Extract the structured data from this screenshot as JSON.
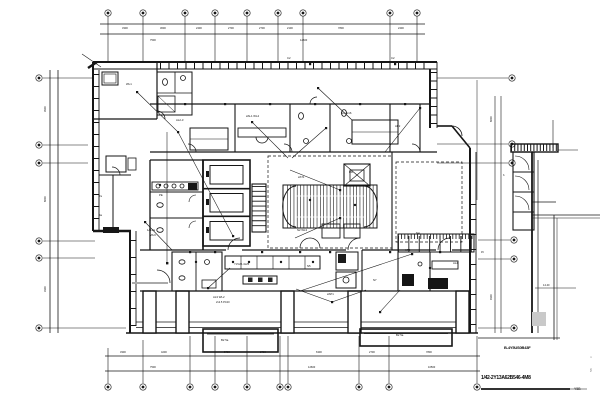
{
  "meta": {
    "drawing_type": "electrical floor plan",
    "background_color": "#ffffff",
    "line_color": "#161616",
    "gray_fill": "#c9c9c9"
  },
  "titleblock": {
    "drawing_title": "1/42-2Y13A62B546-4M8",
    "scale_note": "Y5B"
  },
  "captions": {
    "right_note": "B-4Y5US0B43F"
  },
  "annotations": [
    {
      "x": 122,
      "y": 29,
      "t": "3300",
      "s": 2.6
    },
    {
      "x": 160,
      "y": 29,
      "t": "3600",
      "s": 2.6
    },
    {
      "x": 196,
      "y": 29,
      "t": "2400",
      "s": 2.6
    },
    {
      "x": 228,
      "y": 29,
      "t": "2700",
      "s": 2.6
    },
    {
      "x": 259,
      "y": 29,
      "t": "2700",
      "s": 2.6
    },
    {
      "x": 287,
      "y": 29,
      "t": "2100",
      "s": 2.6
    },
    {
      "x": 338,
      "y": 29,
      "t": "7800",
      "s": 2.6
    },
    {
      "x": 398,
      "y": 29,
      "t": "2400",
      "s": 2.6
    },
    {
      "x": 150,
      "y": 41,
      "t": "7500",
      "s": 2.6
    },
    {
      "x": 300,
      "y": 41,
      "t": "12600",
      "s": 2.6
    },
    {
      "x": 46,
      "y": 112,
      "t": "3900",
      "s": 2.6,
      "r": -90
    },
    {
      "x": 46,
      "y": 202,
      "t": "6600",
      "s": 2.6,
      "r": -90
    },
    {
      "x": 46,
      "y": 292,
      "t": "3300",
      "s": 2.6,
      "r": -90
    },
    {
      "x": 120,
      "y": 353,
      "t": "3300",
      "s": 2.6
    },
    {
      "x": 161,
      "y": 353,
      "t": "4200",
      "s": 2.6
    },
    {
      "x": 224,
      "y": 353,
      "t": "5700",
      "s": 2.6
    },
    {
      "x": 260,
      "y": 353,
      "t": "2700",
      "s": 2.6
    },
    {
      "x": 316,
      "y": 353,
      "t": "6300",
      "s": 2.6
    },
    {
      "x": 369,
      "y": 353,
      "t": "2700",
      "s": 2.6
    },
    {
      "x": 426,
      "y": 353,
      "t": "7800",
      "s": 2.6
    },
    {
      "x": 150,
      "y": 368,
      "t": "7500",
      "s": 2.6
    },
    {
      "x": 308,
      "y": 368,
      "t": "12600",
      "s": 2.6
    },
    {
      "x": 428,
      "y": 368,
      "t": "10500",
      "s": 2.6
    },
    {
      "x": 492,
      "y": 122,
      "t": "6600",
      "s": 2.6,
      "r": -90
    },
    {
      "x": 492,
      "y": 300,
      "t": "9300",
      "s": 2.6,
      "r": -90
    },
    {
      "x": 543,
      "y": 286,
      "t": "14.40",
      "s": 2.6
    },
    {
      "x": 176,
      "y": 121,
      "t": "AL2-3",
      "s": 2.8
    },
    {
      "x": 246,
      "y": 117,
      "t": "2AL1 WL4",
      "s": 2.8
    },
    {
      "x": 341,
      "y": 114,
      "t": "N3 2x16",
      "s": 2.8
    },
    {
      "x": 395,
      "y": 127,
      "t": "AP2",
      "s": 2.8
    },
    {
      "x": 147,
      "y": 231,
      "t": "1AL2a",
      "s": 2.8
    },
    {
      "x": 150,
      "y": 236,
      "t": "WL6",
      "s": 2.8
    },
    {
      "x": 234,
      "y": 265,
      "t": "YJV22-4x25",
      "s": 2.8
    },
    {
      "x": 307,
      "y": 267,
      "t": "N5",
      "s": 2.8
    },
    {
      "x": 213,
      "y": 298,
      "t": "AL3 WL2",
      "s": 2.8
    },
    {
      "x": 216,
      "y": 303,
      "t": "2x2.5 PC20",
      "s": 2.6
    },
    {
      "x": 327,
      "y": 295,
      "t": "2AP1",
      "s": 2.8
    },
    {
      "x": 373,
      "y": 281,
      "t": "N7",
      "s": 2.8
    },
    {
      "x": 405,
      "y": 251,
      "t": "AP3",
      "s": 2.8
    },
    {
      "x": 287,
      "y": 59,
      "t": "C2",
      "s": 2.8
    },
    {
      "x": 391,
      "y": 59,
      "t": "C2",
      "s": 2.8
    },
    {
      "x": 298,
      "y": 178,
      "t": "2AT1",
      "s": 2.8
    },
    {
      "x": 349,
      "y": 173,
      "t": "RD",
      "s": 2.8
    },
    {
      "x": 297,
      "y": 231,
      "t": "N2 WL3",
      "s": 2.8
    },
    {
      "x": 159,
      "y": 196,
      "t": "PE",
      "s": 2.8
    },
    {
      "x": 126,
      "y": 85,
      "t": "WL1",
      "s": 2.8
    },
    {
      "x": 416,
      "y": 234,
      "t": "N4",
      "s": 2.8
    },
    {
      "x": 453,
      "y": 264,
      "t": "AL4",
      "s": 2.8
    },
    {
      "x": 221,
      "y": 341,
      "t": "B2 5a",
      "s": 2.8
    },
    {
      "x": 396,
      "y": 336,
      "t": "B2 5a",
      "s": 2.8
    },
    {
      "x": 99,
      "y": 197,
      "t": "7a",
      "s": 2.6
    },
    {
      "x": 99,
      "y": 216,
      "t": "4a",
      "s": 2.6
    },
    {
      "x": 503,
      "y": 176,
      "t": "b",
      "s": 2.6
    },
    {
      "x": 481,
      "y": 253,
      "t": "45",
      "s": 2.4
    },
    {
      "x": 592,
      "y": 372,
      "t": "5B",
      "s": 3,
      "r": -90,
      "c": "#888888"
    },
    {
      "x": 592,
      "y": 358,
      "t": "C",
      "s": 2.6,
      "r": -90,
      "c": "#888888"
    }
  ]
}
